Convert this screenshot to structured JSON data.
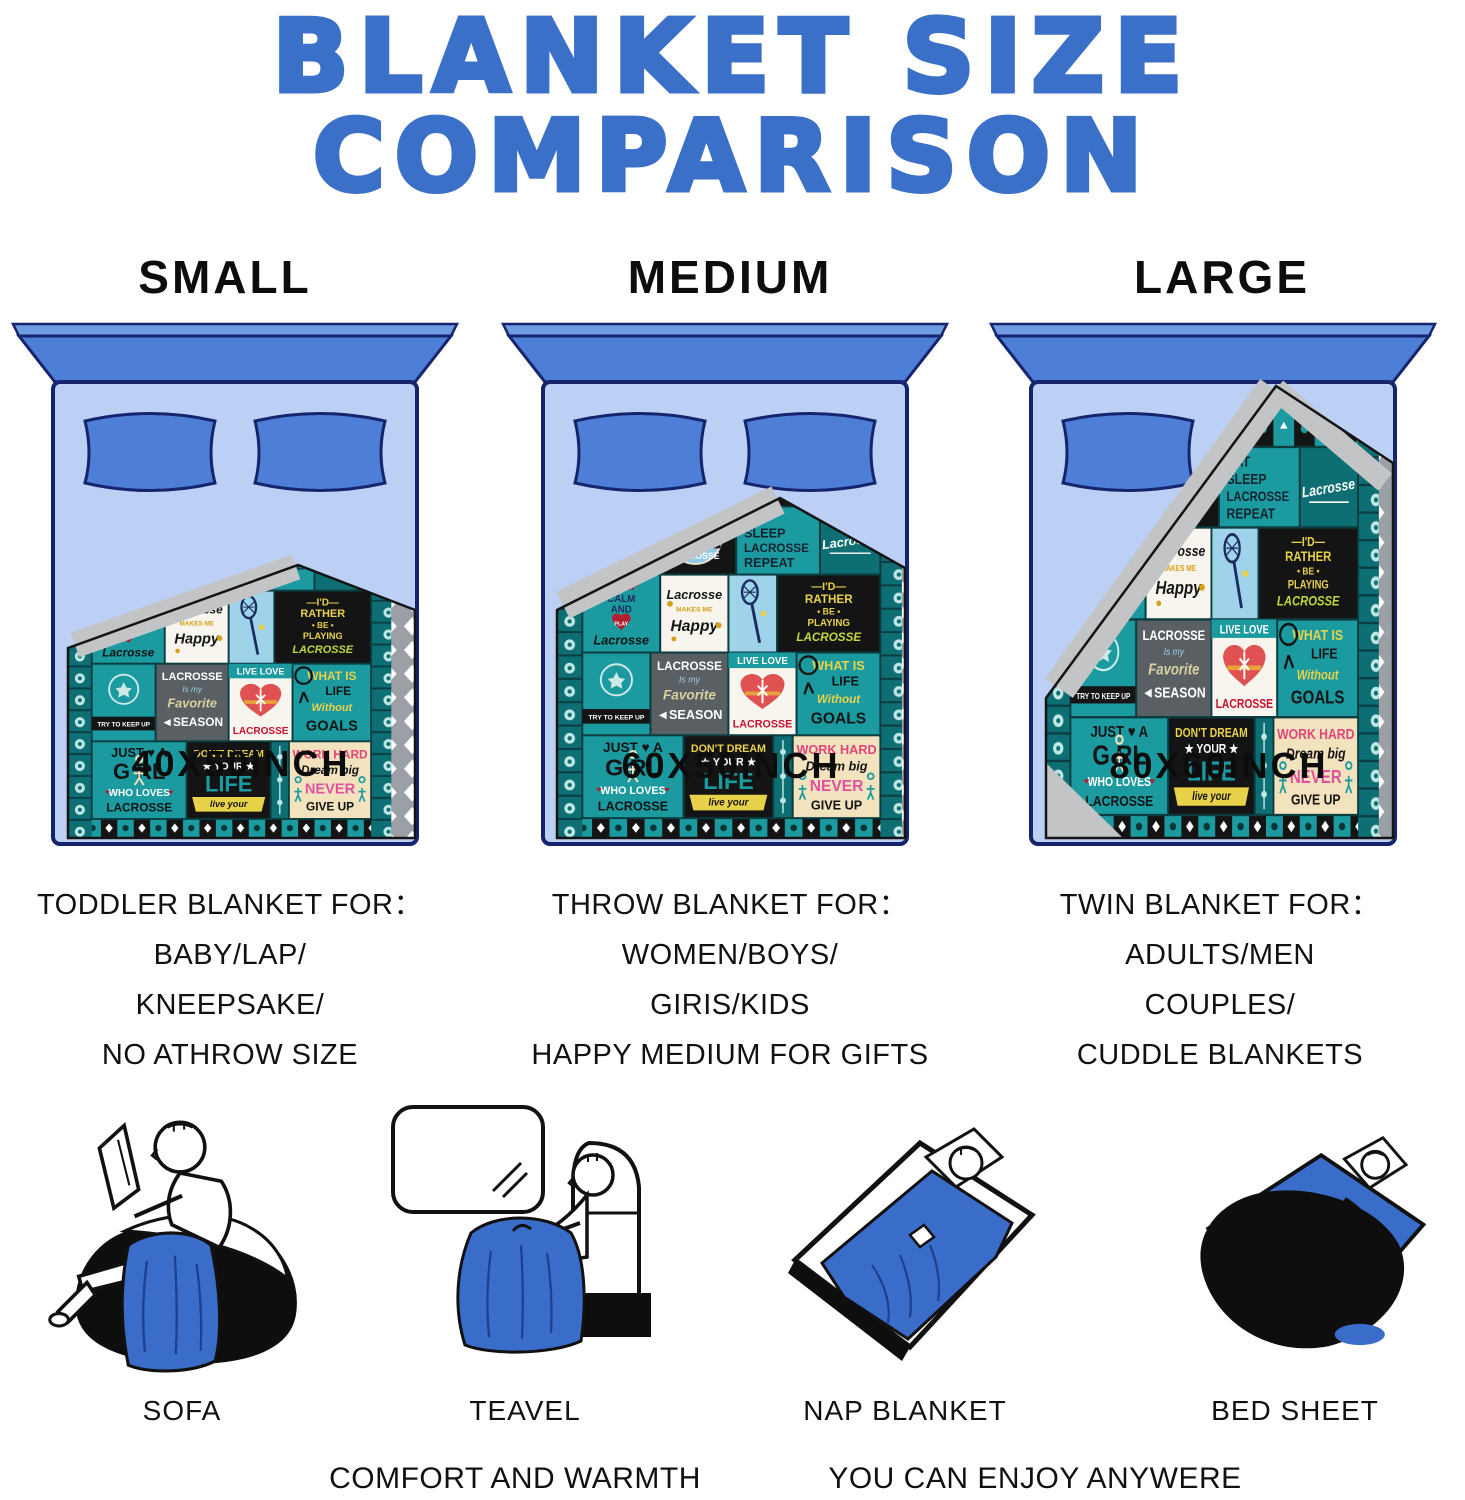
{
  "title": {
    "line1": "BLANKET SIZE",
    "line2": "COMPARISON"
  },
  "columns": [
    {
      "size_label": "SMALL",
      "blanket_size": "40X50INCH",
      "desc": [
        "TODDLER BLANKET FOR：",
        "BABY/LAP/",
        "KNEEPSAKE/",
        "NO ATHROW SIZE"
      ]
    },
    {
      "size_label": "MEDIUM",
      "blanket_size": "60X50INCH",
      "desc": [
        "THROW  BLANKET FOR：",
        "WOMEN/BOYS/",
        "GIRIS/KIDS",
        "HAPPY MEDIUM FOR GIFTS"
      ]
    },
    {
      "size_label": "LARGE",
      "blanket_size": "80X60INCH",
      "desc": [
        "TWIN BLANKET  FOR：",
        "ADULTS/MEN",
        "COUPLES/",
        "CUDDLE BLANKETS"
      ]
    }
  ],
  "art": {
    "strip_top_left": "LACROSSE",
    "badge": {
      "l1": "EVERY DAY IS A",
      "l2": "GOOD DAY",
      "l3": "TO PLAY",
      "l4": "LACROSSE"
    },
    "eat_sleep": {
      "l1": "EAT",
      "l2": "SLEEP",
      "l3": "LACROSSE",
      "l4": "REPEAT"
    },
    "script_lacrosse": "Lacrosse",
    "keep_calm": {
      "l1": "KEEP",
      "l2": "CALM",
      "l3": "AND",
      "l4": "PLAY",
      "l5": "Lacrosse"
    },
    "happy": {
      "l1": "Lacrosse",
      "l2": "MAKES ME",
      "l3": "Happy"
    },
    "id_rather": {
      "l1": "—I'D—",
      "l2": "RATHER",
      "l3": "• BE •",
      "l4": "PLAYING",
      "l5": "LACROSSE"
    },
    "try_keep_up": "TRY TO KEEP UP",
    "season": {
      "l1": "LACROSSE",
      "l2": "Is my",
      "l3": "Favorite",
      "l4": "◄SEASON"
    },
    "live_love": {
      "l1": "LIVE LOVE",
      "l2": "LACROSSE"
    },
    "goals": {
      "l1": "WHAT IS",
      "l2": "LIFE",
      "l3": "Without",
      "l4": "GOALS"
    },
    "girl": {
      "l1": "JUST ♥ A",
      "l2": "G RL",
      "l3": "WHO LOVES",
      "l4": "LACROSSE"
    },
    "dream": {
      "l1": "DON'T DREAM",
      "l2": "★ YOUR ★",
      "l3": "LIFE",
      "l4": "live your"
    },
    "work_hard": {
      "l1": "WORK HARD",
      "l2": "Dream big",
      "l3": "NEVER",
      "l4": "GIVE UP"
    }
  },
  "usage": [
    {
      "label": "SOFA"
    },
    {
      "label": "TEAVEL"
    },
    {
      "label": "NAP BLANKET"
    },
    {
      "label": "BED SHEET"
    }
  ],
  "footer": {
    "left": "COMFORT AND WARMTH",
    "right": "YOU CAN ENJOY ANYWERE"
  },
  "colors": {
    "title_blue": "#3b70c8",
    "headboard_blue": "#4d7fd6",
    "bed_light_blue": "#bcd0f5",
    "outline_navy": "#16246e",
    "blanket_teal": "#1b9aa0",
    "blanket_dark_teal": "#0d6e74",
    "fold_gray": "#c3c4c6",
    "cream": "#f2e2bd",
    "illustration_blue": "#3a6dc9"
  }
}
